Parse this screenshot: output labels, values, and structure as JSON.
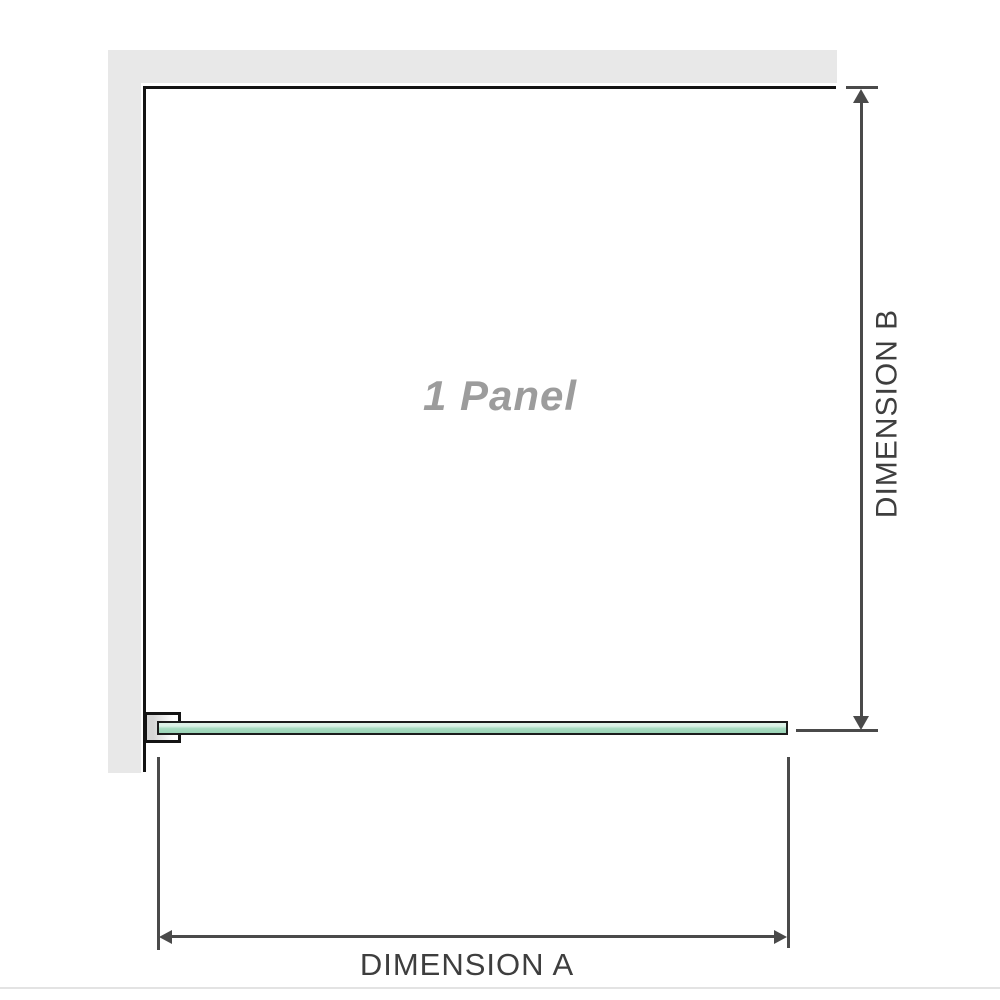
{
  "diagram": {
    "panel": {
      "label": "1 Panel"
    },
    "dimension_a": {
      "label": "DIMENSION A"
    },
    "dimension_b": {
      "label": "DIMENSION B"
    },
    "colors": {
      "wall": "#e8e8e8",
      "panel_outline": "#141414",
      "glass_fill": "#a7dbc0",
      "glass_highlight": "#ddf2e7",
      "glass_border": "#1c1c1c",
      "bracket_fill": "#d6d6d6",
      "dimension_lines": "#4a4a4a",
      "dimension_label_text": "#3e3e3e",
      "panel_label_text": "#9c9c9c",
      "footer_rule": "#e3e3e3"
    }
  }
}
